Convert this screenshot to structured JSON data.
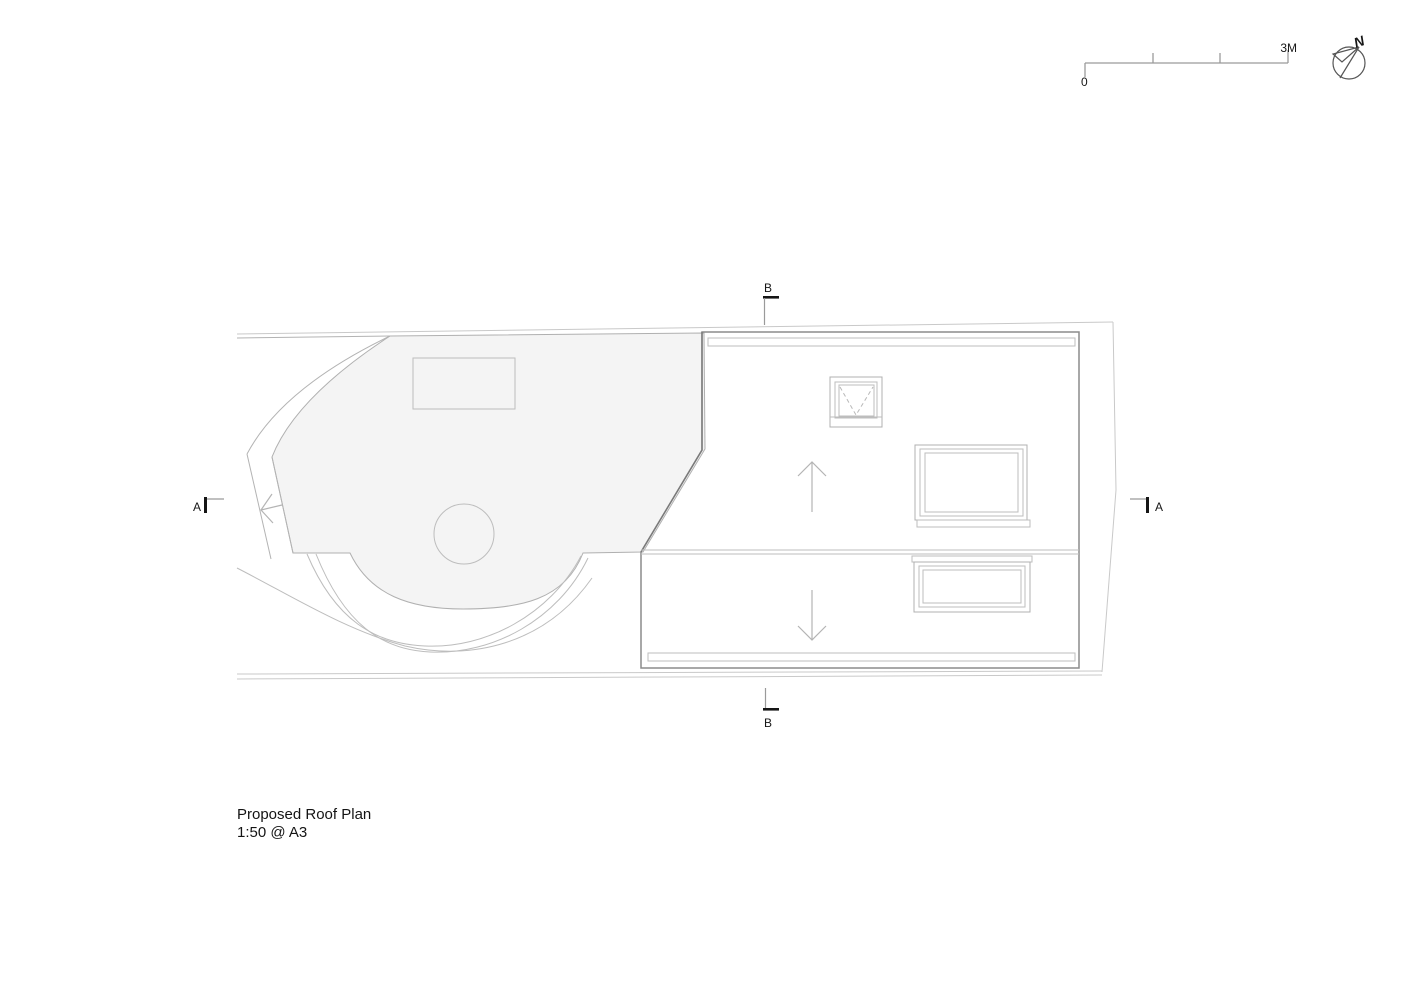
{
  "drawing": {
    "type": "architectural roof plan",
    "title": "Proposed Roof Plan",
    "scale_note": "1:50 @ A3"
  },
  "scale_bar": {
    "start_label": "0",
    "end_label": "3M",
    "divisions": 3
  },
  "north_arrow": {
    "label": "N",
    "icon": "north-compass-icon"
  },
  "sections": {
    "a_label": "A",
    "b_label": "B"
  },
  "plan_elements": {
    "left_roof": "flat roof area with rooflight rectangle, circular feature, curved parapet bay and sloped access strip with fall arrow",
    "right_roof": "dual-pitch roof with ridge, eaves gutters, three rooflights and slope arrows",
    "slope_arrows": [
      "up",
      "down"
    ],
    "fall_arrow": "left-pointing fall arrow on side strip"
  },
  "colors": {
    "background": "#ffffff",
    "site_boundary": "#c9c9c9",
    "roof_outline": "#8c8c8c",
    "detail_lines": "#b4b4b4",
    "left_roof_fill": "#f4f4f4",
    "text": "#161616"
  }
}
